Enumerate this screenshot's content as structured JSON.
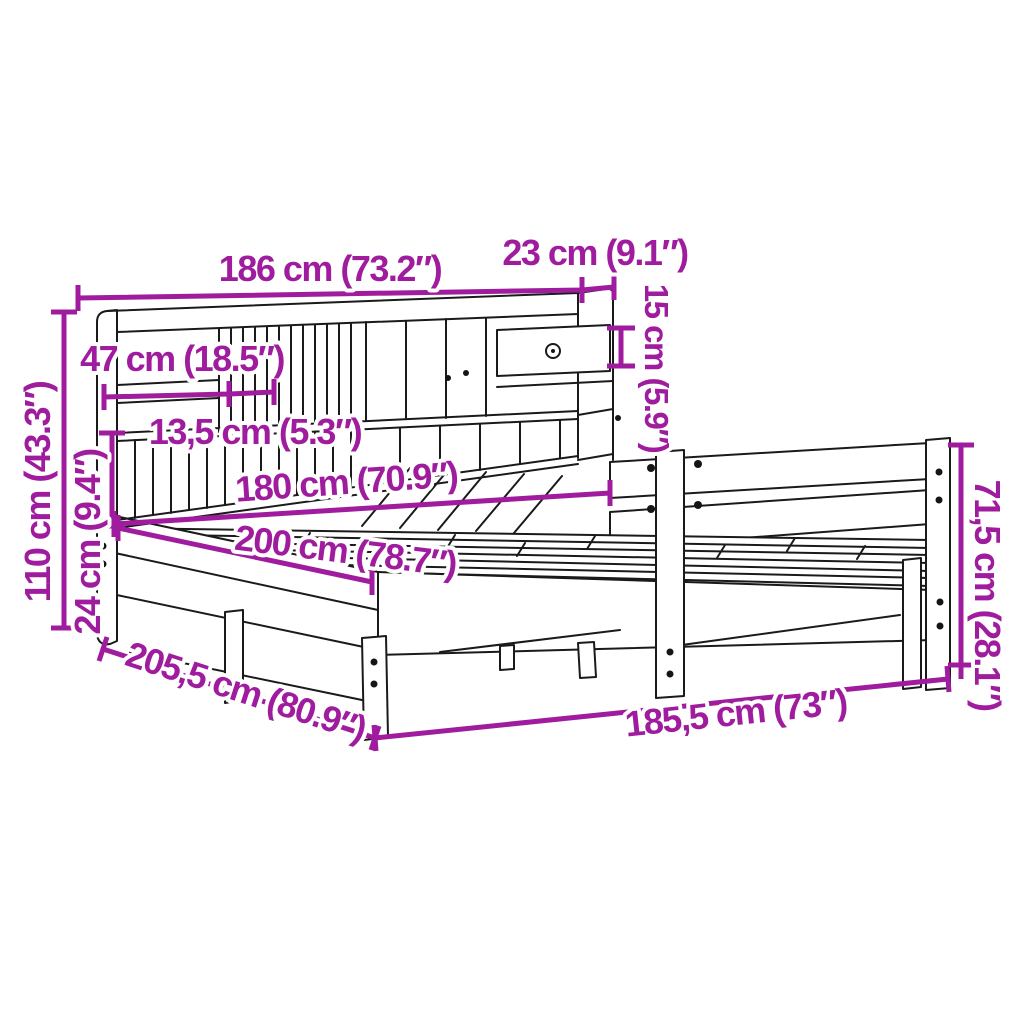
{
  "diagram": {
    "subject": "Bed frame with bookcase headboard - dimension line drawing",
    "colors": {
      "dimension_accent": "#A01C9E",
      "line_art": "#1A1A1A",
      "background": "#FFFFFF"
    },
    "labels": {
      "bookcase_width": "186 cm (73.2″)",
      "bookcase_depth": "23 cm (9.1″)",
      "drawer_height": "15 cm (5.9″)",
      "shelf_compartment_width": "47 cm (18.5″)",
      "small_slot_width": "13,5 cm (5.3″)",
      "headboard_height": "110 cm (43.3″)",
      "shelf_clearance_height": "24 cm (9.4″)",
      "mattress_width": "180 cm (70.9″)",
      "mattress_length": "200 cm (78.7″)",
      "total_length": "205,5 cm (80.9″)",
      "frame_width": "185,5 cm (73″)",
      "side_rail_height": "71,5 cm (28.1″)"
    }
  }
}
